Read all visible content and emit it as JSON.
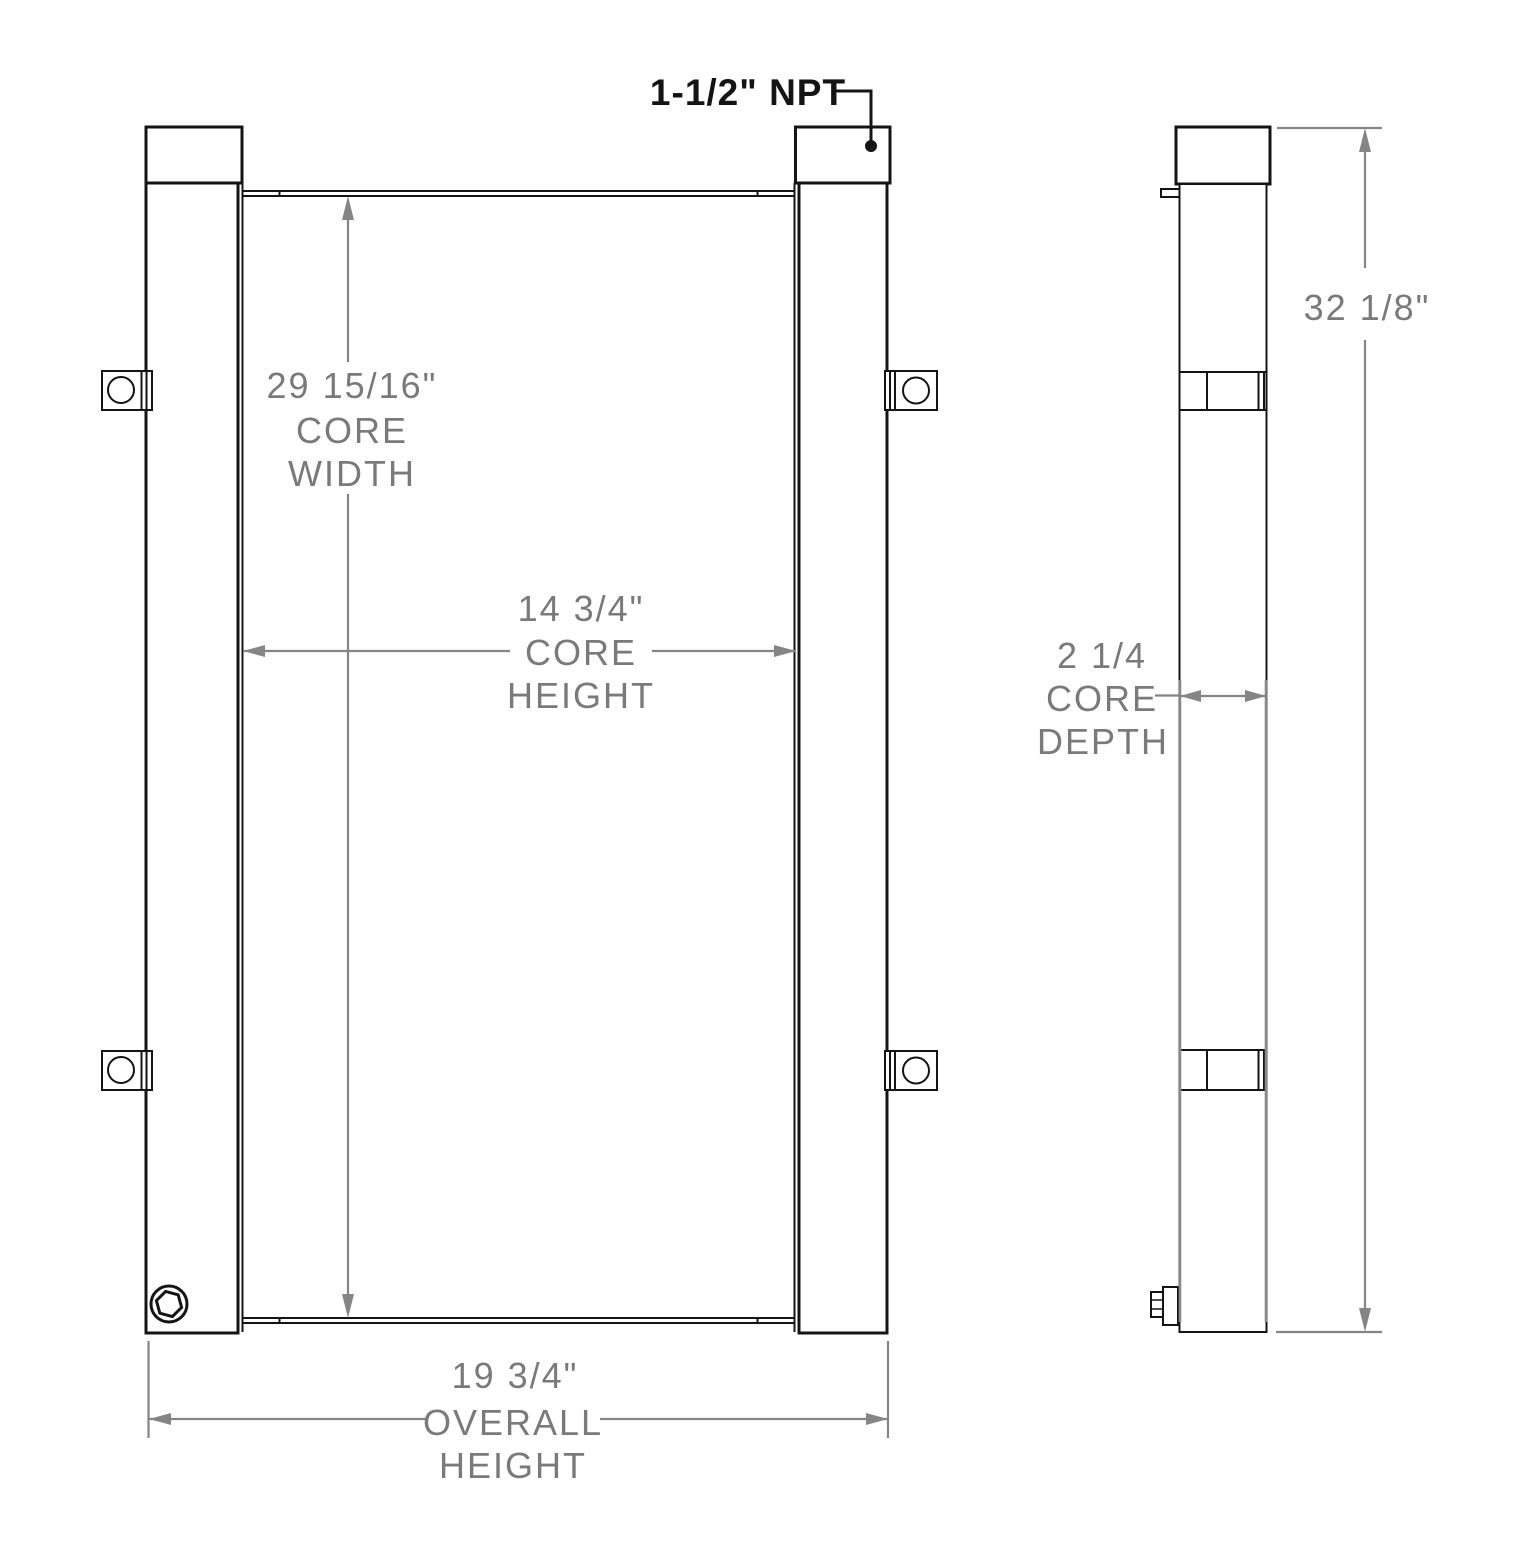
{
  "annotations": {
    "npt_port": "1-1/2\" NPT"
  },
  "dimensions": {
    "core_width": {
      "value": "29 15/16\"",
      "label_line1": "CORE",
      "label_line2": "WIDTH"
    },
    "core_height": {
      "value": "14 3/4\"",
      "label_line1": "CORE",
      "label_line2": "HEIGHT"
    },
    "overall_height": {
      "value": "19 3/4\"",
      "label_line1": "OVERALL",
      "label_line2": "HEIGHT"
    },
    "core_depth": {
      "value": "2 1/4",
      "label_line1": "CORE",
      "label_line2": "DEPTH"
    },
    "side_overall_height": {
      "value": "32 1/8\""
    }
  },
  "colors": {
    "object_line": "#141414",
    "dimension": "#858585",
    "background": "#ffffff"
  }
}
